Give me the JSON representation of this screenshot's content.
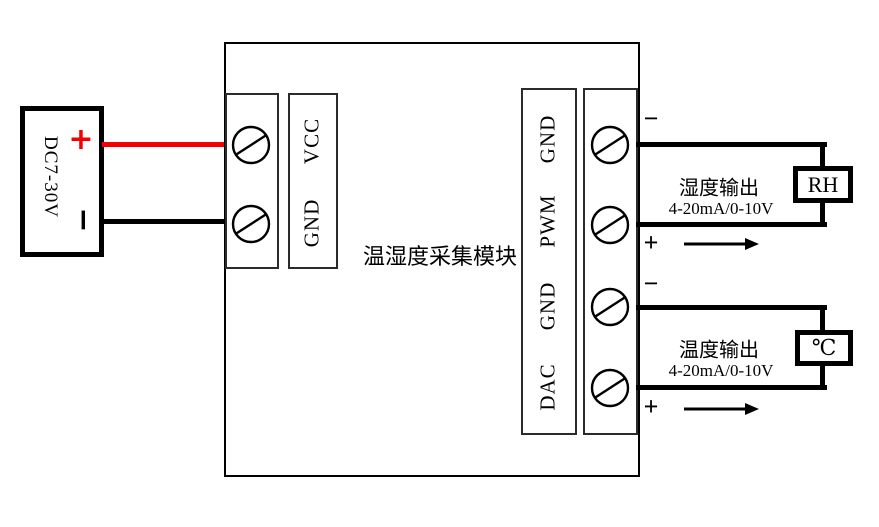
{
  "power_supply": {
    "label": "DC7-30V",
    "positive": "+",
    "negative": "−"
  },
  "module": {
    "title": "温湿度采集模块",
    "power_terminals": [
      "VCC",
      "GND"
    ],
    "signal_terminals": [
      "GND",
      "PWM",
      "GND",
      "DAC"
    ]
  },
  "outputs": {
    "humidity": {
      "negative": "−",
      "positive": "+",
      "name": "湿度输出",
      "signal": "4-20mA/0-10V",
      "sensor": "RH"
    },
    "temperature": {
      "negative": "−",
      "positive": "+",
      "name": "温度输出",
      "signal": "4-20mA/0-10V",
      "sensor": "℃"
    }
  },
  "colors": {
    "positive_wire": "#f40000",
    "negative_wire": "#000000",
    "line": "#000000"
  }
}
